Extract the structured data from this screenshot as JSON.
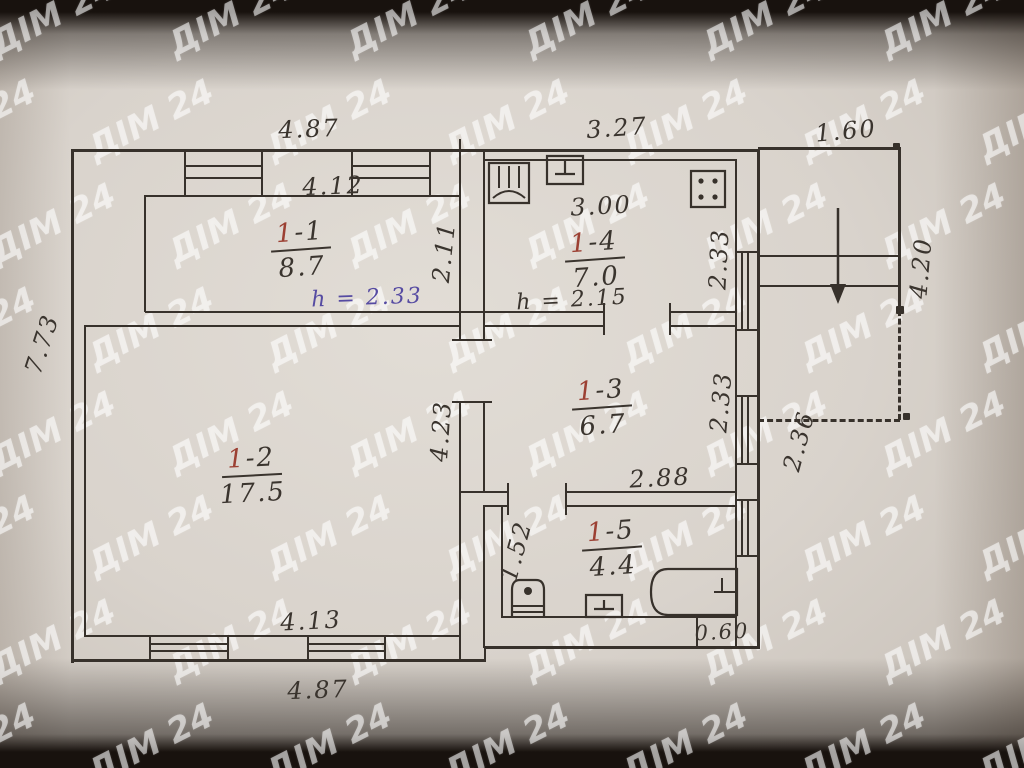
{
  "watermark": {
    "text": "ДІМ 24"
  },
  "dims": {
    "top_left": "4.87",
    "top_mid": "3.27",
    "top_right": "1.60",
    "left_side": "7.73",
    "bottom": "4.87",
    "porch_height": "4.20",
    "porch_lower": "2.36"
  },
  "rooms": {
    "r11": {
      "num_red": "1",
      "num_rest": "-1",
      "area": "8.7",
      "width": "4.12",
      "depth": "2.11",
      "height_note": "h = 2.33"
    },
    "r14": {
      "num_red": "1",
      "num_rest": "-4",
      "area": "7.0",
      "width": "3.00",
      "depth": "2.33",
      "height_note": "h = 2.15"
    },
    "r12": {
      "num_red": "1",
      "num_rest": "-2",
      "area": "17.5",
      "width": "4.13",
      "depth": "4.23"
    },
    "r13": {
      "num_red": "1",
      "num_rest": "-3",
      "area": "6.7",
      "width": "2.88",
      "depth": "2.33"
    },
    "r15": {
      "num_red": "1",
      "num_rest": "-5",
      "area": "4.4",
      "depth": "1.52",
      "step": "0.60"
    }
  },
  "colors": {
    "pencil": "#3a342e",
    "red_ink": "#9c4033",
    "purple_ink": "#564ba2",
    "paper": "#d9d3cc",
    "watermark_white": "#ffffff"
  }
}
